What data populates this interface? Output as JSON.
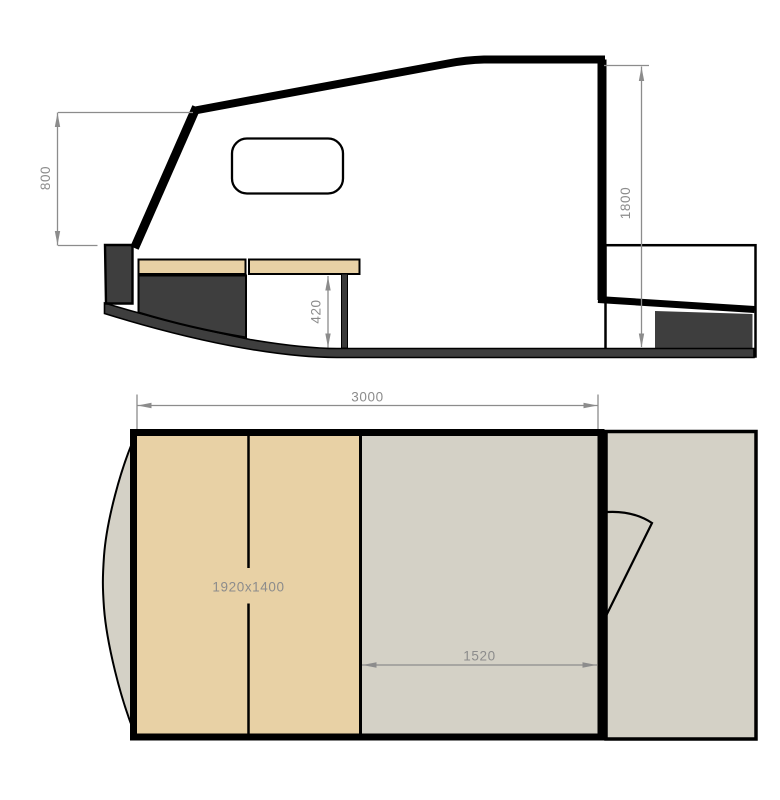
{
  "colors": {
    "background": "#ffffff",
    "tan": "#e8d1a5",
    "surface_gray": "#d4d1c6",
    "dark_gray": "#3e3e3e",
    "dim_gray": "#8c8c8c",
    "outline_black": "#000000"
  },
  "side_view": {
    "dim_front_height": "800",
    "dim_rear_height": "1800",
    "dim_berth_height": "420"
  },
  "plan_view": {
    "dim_overall_length": "3000",
    "dim_cockpit_length": "1520",
    "berth_size_label": "1920x1400"
  }
}
